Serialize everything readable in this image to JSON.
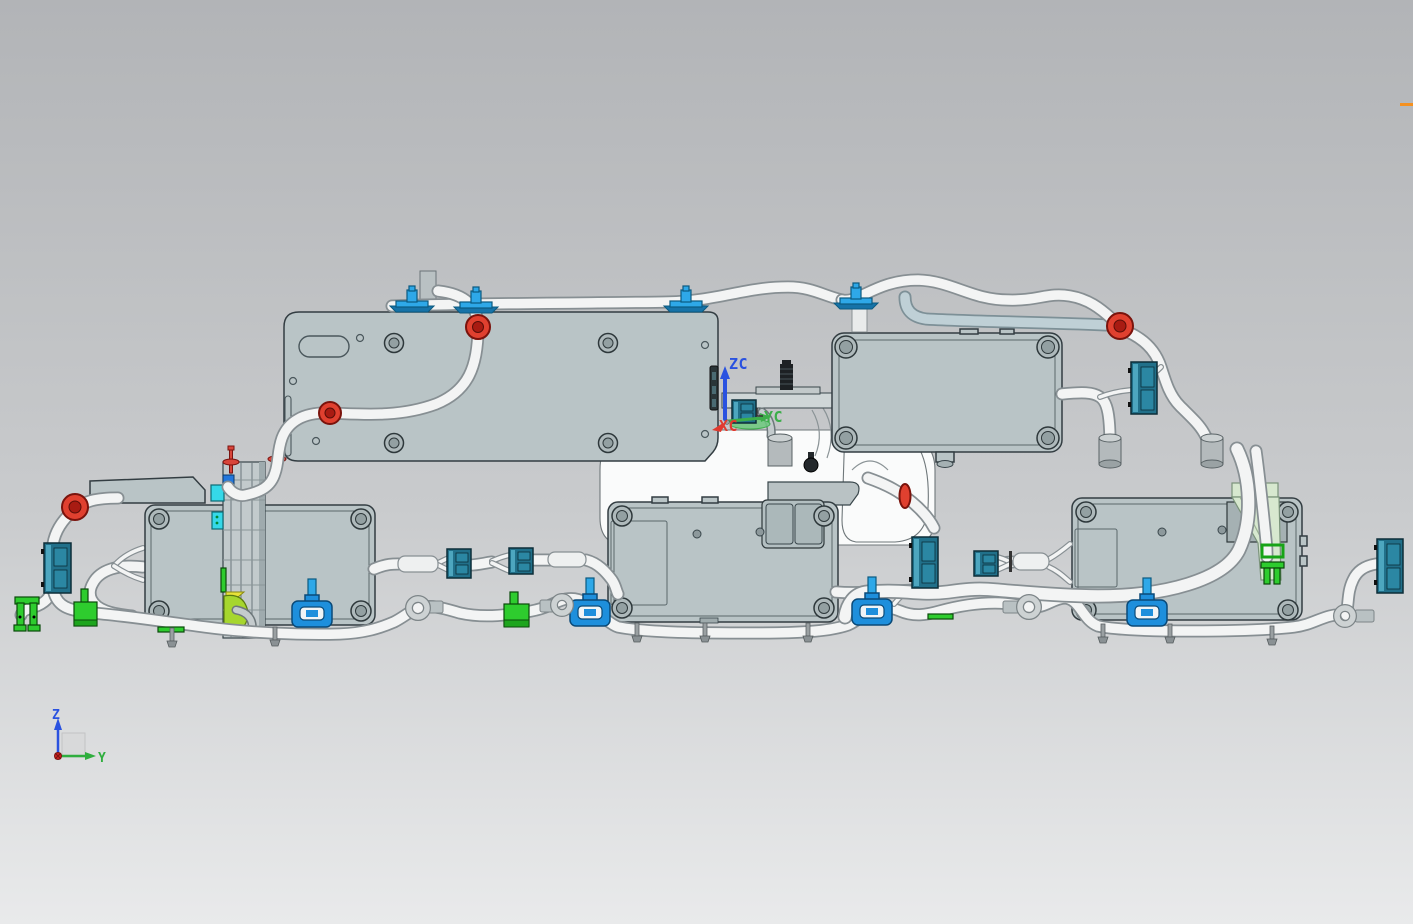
{
  "wcs": {
    "zc_label": "ZC",
    "yc_label": "YC",
    "xc_label": "XC"
  },
  "view_triad": {
    "z_label": "Z",
    "y_label": "Y"
  },
  "colors": {
    "bg_top": "#b2b4b7",
    "bg_mid": "#c9cbcd",
    "bg_bottom": "#e9eaeb",
    "module_fill": "#b9c4c6",
    "module_fill_dark": "#a5b1b3",
    "module_edge": "#333d42",
    "module_inner_edge": "#5a676b",
    "machine_fill": "#fafbfb",
    "machine_edge": "#6f777a",
    "cable_fill": "#f3f4f4",
    "cable_edge": "#878f93",
    "tube_fill": "#bfd0d6",
    "tube_edge": "#7d9097",
    "grommet_red": "#e0402f",
    "clip_blue": "#2ea8e8",
    "clamp_blue": "#1e8fdc",
    "teal_fill": "#21708a",
    "teal_light": "#4da6bf",
    "teal_dark": "#0c2d38",
    "green_fill": "#2ecc2e",
    "green_dark": "#0a4a0a",
    "lime": "#a6d62e",
    "yellow": "#e8e23a",
    "pale_green": "#d7e8cf",
    "cyan": "#35d8e8",
    "panel_dark_slot": "#2a3538",
    "highlight_orange": "#f59120",
    "zc_blue": "#2a52e0",
    "yc_green": "#3cae4a",
    "xc_red": "#e03a2f",
    "triad_z": "#2a52e0",
    "triad_y": "#2fae3e",
    "triad_origin": "#cc2222"
  }
}
